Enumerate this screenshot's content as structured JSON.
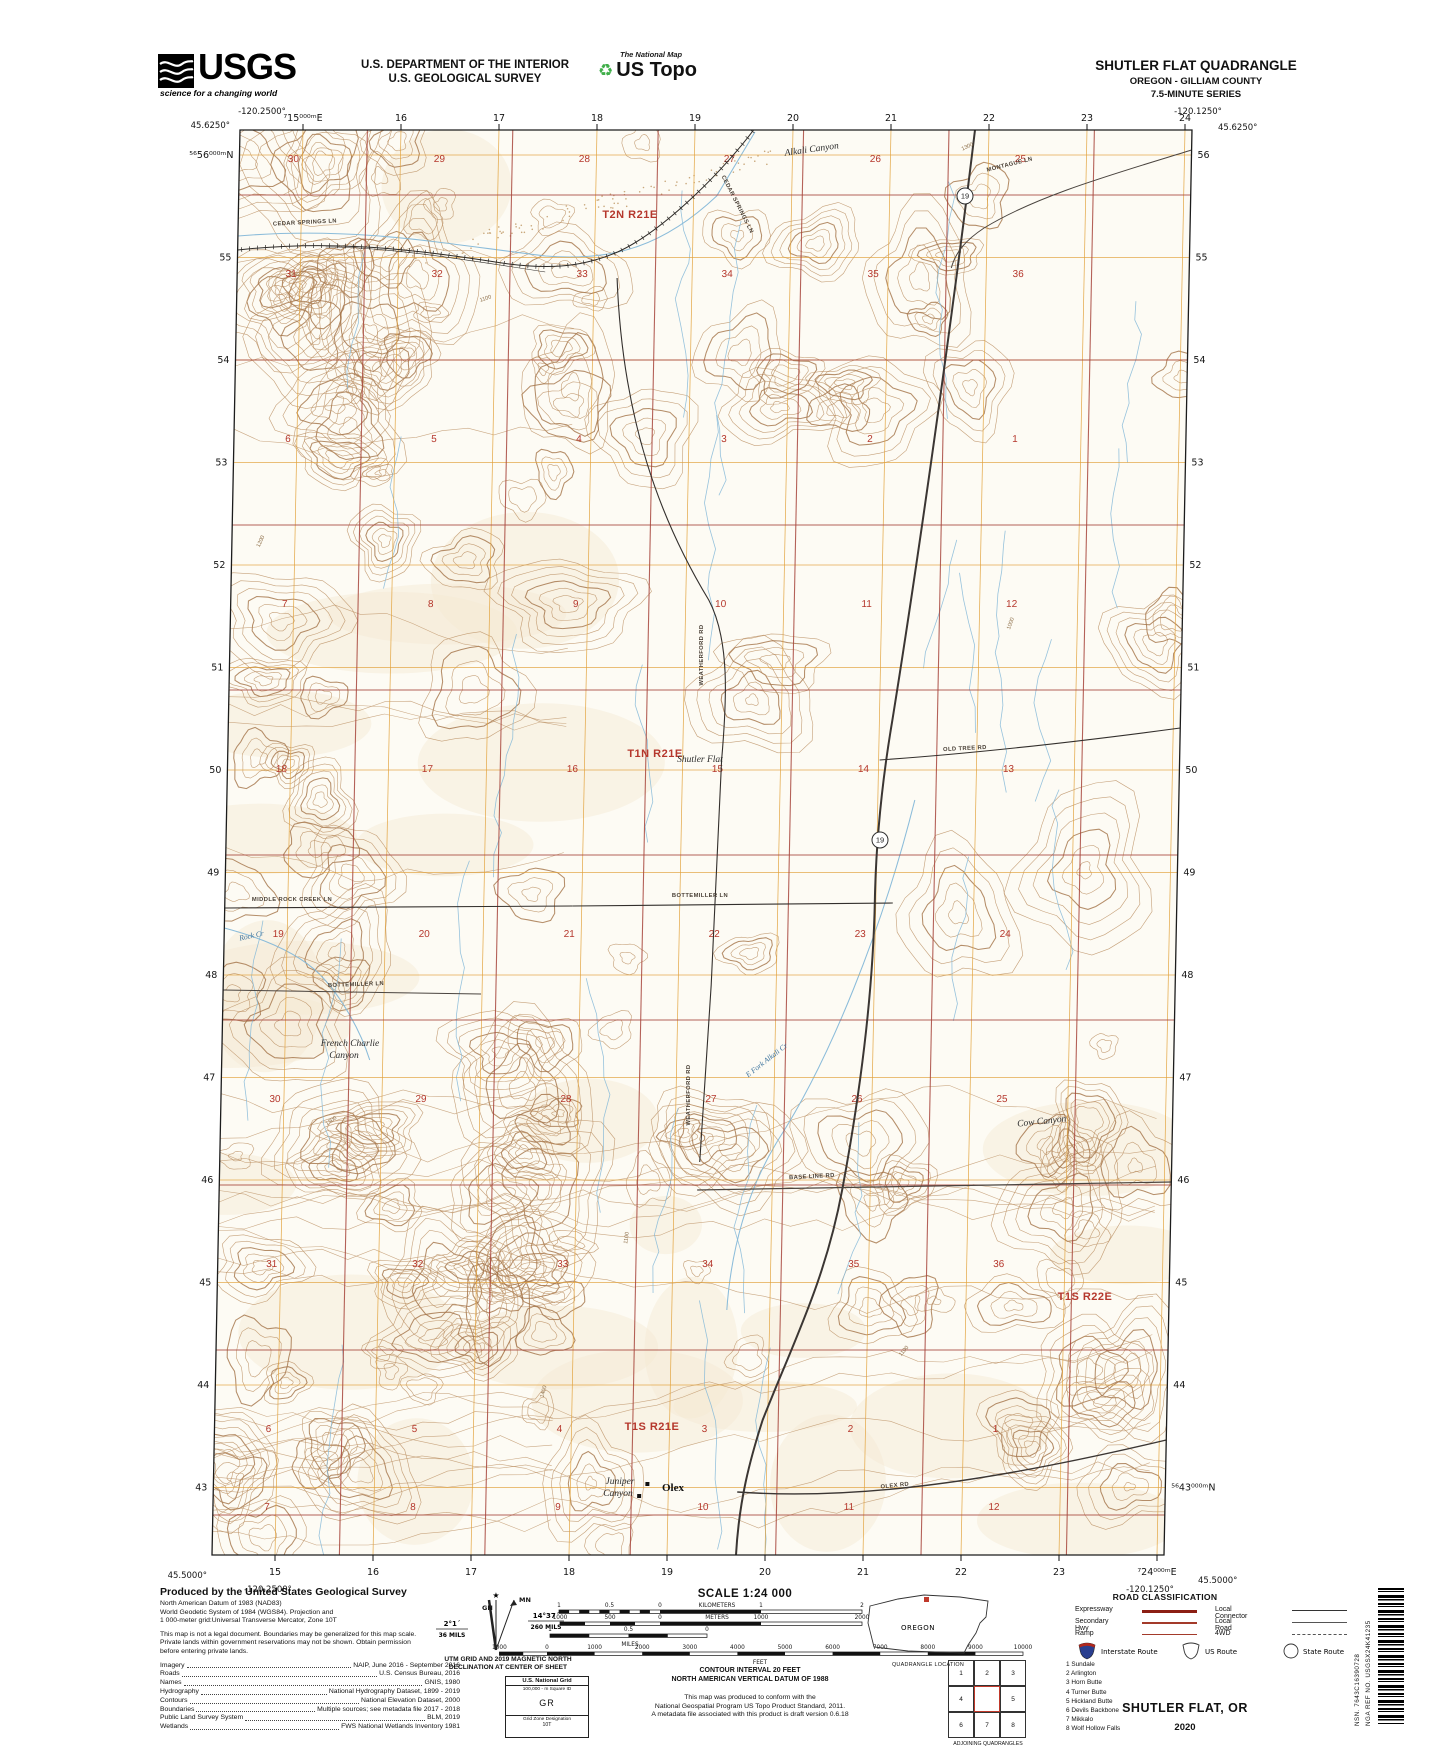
{
  "header": {
    "logo_text": "USGS",
    "logo_tagline": "science for a changing world",
    "dept1": "U.S. DEPARTMENT OF THE INTERIOR",
    "dept2": "U.S. GEOLOGICAL SURVEY",
    "natmap": "The National Map",
    "ustopo": "US Topo",
    "title": "SHUTLER FLAT QUADRANGLE",
    "subtitle1": "OREGON - GILLIAM COUNTY",
    "subtitle2": "7.5-MINUTE SERIES"
  },
  "map": {
    "corners": {
      "nw_lon": "-120.2500°",
      "nw_lat": "45.6250°",
      "ne_lon": "-120.1250°",
      "ne_lat": "45.6250°",
      "sw_lat": "45.5000°",
      "sw_lon": "-120.2500°",
      "se_lon": "-120.1250°",
      "se_lat": "45.5000°"
    },
    "ticks_top": [
      "⁷15⁰⁰⁰ᵐE",
      "16",
      "17",
      "18",
      "19",
      "20",
      "21",
      "22",
      "23",
      "24"
    ],
    "ticks_bottom": [
      "15",
      "16",
      "17",
      "18",
      "19",
      "20",
      "21",
      "22",
      "23",
      "⁷24⁰⁰⁰ᵐE"
    ],
    "ticks_left": [
      "⁵⁶56⁰⁰⁰ᵐN",
      "55",
      "54",
      "53",
      "52",
      "51",
      "50",
      "49",
      "48",
      "47",
      "46",
      "45",
      "44",
      "43"
    ],
    "ticks_right": [
      "56",
      "55",
      "54",
      "53",
      "52",
      "51",
      "50",
      "49",
      "48",
      "47",
      "46",
      "45",
      "44",
      "⁵⁶43⁰⁰⁰ᵐN"
    ],
    "township_labels": [
      {
        "text": "T2N R21E",
        "x": 630,
        "y": 218
      },
      {
        "text": "T1N R21E",
        "x": 655,
        "y": 757
      },
      {
        "text": "T1S R21E",
        "x": 652,
        "y": 1430
      },
      {
        "text": "T1S R22E",
        "x": 1085,
        "y": 1300
      }
    ],
    "section_grid": {
      "col_x": [
        266,
        412,
        557,
        702,
        848,
        993
      ],
      "rows": [
        {
          "y": 162,
          "nums": [
            "30",
            "29",
            "28",
            "27",
            "26",
            "25"
          ]
        },
        {
          "y": 277,
          "nums": [
            "31",
            "32",
            "33",
            "34",
            "35",
            "36"
          ]
        },
        {
          "y": 442,
          "nums": [
            "6",
            "5",
            "4",
            "3",
            "2",
            "1"
          ]
        },
        {
          "y": 607,
          "nums": [
            "7",
            "8",
            "9",
            "10",
            "11",
            "12"
          ]
        },
        {
          "y": 772,
          "nums": [
            "18",
            "17",
            "16",
            "15",
            "14",
            "13"
          ]
        },
        {
          "y": 937,
          "nums": [
            "19",
            "20",
            "21",
            "22",
            "23",
            "24"
          ]
        },
        {
          "y": 1102,
          "nums": [
            "30",
            "29",
            "28",
            "27",
            "26",
            "25"
          ]
        },
        {
          "y": 1267,
          "nums": [
            "31",
            "32",
            "33",
            "34",
            "35",
            "36"
          ]
        },
        {
          "y": 1432,
          "nums": [
            "6",
            "5",
            "4",
            "3",
            "2",
            "1"
          ]
        },
        {
          "y": 1510,
          "nums": [
            "7",
            "8",
            "9",
            "10",
            "11",
            "12"
          ]
        }
      ]
    },
    "place_labels": [
      {
        "text": "Alkali Canyon",
        "x": 812,
        "y": 152,
        "rot": -8
      },
      {
        "text": "Shutler Flat",
        "x": 700,
        "y": 762,
        "rot": 0
      },
      {
        "text": "French Charlie",
        "x": 350,
        "y": 1046,
        "rot": 0
      },
      {
        "text": "Canyon",
        "x": 344,
        "y": 1058,
        "rot": 0
      },
      {
        "text": "Cow Canyon",
        "x": 1042,
        "y": 1124,
        "rot": -6
      },
      {
        "text": "Juniper",
        "x": 620,
        "y": 1484,
        "rot": 0
      },
      {
        "text": "Canyon",
        "x": 618,
        "y": 1496,
        "rot": 0
      }
    ],
    "town_label": {
      "text": "Olex",
      "x": 662,
      "y": 1491
    },
    "road_labels": [
      {
        "text": "CEDAR SPRINGS LN",
        "x": 305,
        "y": 224,
        "rot": -3
      },
      {
        "text": "CEDAR SPRINGS LN",
        "x": 736,
        "y": 205,
        "rot": 63
      },
      {
        "text": "MONTAGUE LN",
        "x": 1010,
        "y": 166,
        "rot": -14
      },
      {
        "text": "WEATHERFORD RD",
        "x": 703,
        "y": 655,
        "rot": -90
      },
      {
        "text": "WEATHERFORD RD",
        "x": 690,
        "y": 1095,
        "rot": -90
      },
      {
        "text": "OLD TREE RD",
        "x": 965,
        "y": 750,
        "rot": -3
      },
      {
        "text": "BOTTEMILLER LN",
        "x": 700,
        "y": 897,
        "rot": 0
      },
      {
        "text": "BOTTEMILLER LN",
        "x": 356,
        "y": 986,
        "rot": -2
      },
      {
        "text": "MIDDLE ROCK CREEK LN",
        "x": 292,
        "y": 901,
        "rot": 0
      },
      {
        "text": "BASE LINE RD",
        "x": 812,
        "y": 1178,
        "rot": -3
      },
      {
        "text": "OLEX RD",
        "x": 895,
        "y": 1487,
        "rot": -6
      }
    ],
    "water_labels": [
      {
        "text": "Rock Cr",
        "x": 252,
        "y": 938,
        "rot": -12
      },
      {
        "text": "E Fork Alkali Cr",
        "x": 768,
        "y": 1062,
        "rot": -38
      }
    ],
    "route_shields": [
      {
        "num": "19",
        "x": 965,
        "y": 196
      },
      {
        "num": "19",
        "x": 880,
        "y": 840
      }
    ],
    "contour_labels": [
      {
        "text": "1100",
        "x": 486,
        "y": 300,
        "rot": -18
      },
      {
        "text": "1200",
        "x": 262,
        "y": 542,
        "rot": -65
      },
      {
        "text": "1300",
        "x": 332,
        "y": 1122,
        "rot": -35
      },
      {
        "text": "1400",
        "x": 545,
        "y": 1392,
        "rot": -75
      },
      {
        "text": "1100",
        "x": 628,
        "y": 1238,
        "rot": -82
      },
      {
        "text": "1300",
        "x": 968,
        "y": 148,
        "rot": -25
      },
      {
        "text": "1000",
        "x": 1012,
        "y": 624,
        "rot": -70
      },
      {
        "text": "1100",
        "x": 905,
        "y": 1352,
        "rot": -50
      }
    ]
  },
  "footer": {
    "produced_by": "Produced by the United States Geological Survey",
    "datum_lines": [
      "North American Datum of 1983 (NAD83)",
      "World Geodetic System of 1984 (WGS84).  Projection and",
      "1 000-meter grid:Universal Transverse Mercator, Zone 10T"
    ],
    "disclaimer": "This map is not a legal document. Boundaries may be generalized for this map scale. Private lands within government reservations may not be shown. Obtain permission before entering private lands.",
    "sources": [
      [
        "Imagery",
        "NAIP, June 2016 - September 2016"
      ],
      [
        "Roads",
        "U.S. Census Bureau, 2016"
      ],
      [
        "Names",
        "GNIS, 1980"
      ],
      [
        "Hydrography",
        "National Hydrography Dataset, 1899 - 2019"
      ],
      [
        "Contours",
        "National Elevation Dataset, 2000"
      ],
      [
        "Boundaries",
        "Multiple sources; see metadata file 2017 - 2018"
      ],
      [
        "Public Land Survey System",
        "BLM, 2019"
      ],
      [
        "Wetlands",
        "FWS National Wetlands Inventory 1981"
      ]
    ],
    "declination": {
      "gn": "GN",
      "mn": "MN",
      "gn_deg": "2°1´",
      "gn_mils": "36 MILS",
      "mn_deg": "14°37´",
      "mn_mils": "260 MILS",
      "caption1": "UTM GRID AND 2019 MAGNETIC NORTH",
      "caption2": "DECLINATION AT CENTER OF SHEET"
    },
    "usng": {
      "title": "U.S. National Grid",
      "sq_label": "100,000 - m Square ID",
      "square": "GR",
      "zone_label": "Grid Zone Designation",
      "zone": "10T"
    },
    "scale": {
      "title": "SCALE 1:24 000",
      "km_labels": [
        "1",
        "0.5",
        "0",
        "1",
        "2"
      ],
      "km_unit": "KILOMETERS",
      "m_labels": [
        "1000",
        "500",
        "0",
        "1000",
        "2000"
      ],
      "m_unit": "METERS",
      "mi_labels": [
        "1",
        "0.5",
        "0"
      ],
      "mi_unit": "MILES",
      "ft_labels": [
        "1000",
        "0",
        "1000",
        "2000",
        "3000",
        "4000",
        "5000",
        "6000",
        "7000",
        "8000",
        "9000",
        "10000"
      ],
      "ft_unit": "FEET"
    },
    "contour_note1": "CONTOUR INTERVAL 20 FEET",
    "contour_note2": "NORTH AMERICAN VERTICAL DATUM OF 1988",
    "conform_lines": [
      "This map was produced to conform with the",
      "National Geospatial Program US Topo Product Standard, 2011.",
      "A metadata file associated with this product is draft version 0.6.18"
    ],
    "state_name": "OREGON",
    "quad_location_caption": "QUADRANGLE LOCATION",
    "adjoining": {
      "cells": [
        "1",
        "2",
        "3",
        "4",
        "",
        "5",
        "6",
        "7",
        "8"
      ],
      "names": [
        "1 Sundale",
        "2 Arlington",
        "3 Horn Butte",
        "4 Turner Butte",
        "5 Hickland Butte",
        "6 Devils Backbone",
        "7 Mikkalo",
        "8 Wolf Hollow Falls"
      ],
      "caption": "ADJOINING QUADRANGLES"
    },
    "road_class": {
      "title": "ROAD CLASSIFICATION",
      "left": [
        "Expressway",
        "Secondary Hwy",
        "Ramp"
      ],
      "right": [
        "Local Connector",
        "Local Road",
        "4WD"
      ],
      "shield_labels": [
        "Interstate Route",
        "US Route",
        "State Route"
      ]
    },
    "sheet_title": "SHUTLER FLAT,  OR",
    "sheet_year": "2020",
    "nsn": "NSN.  7643C16390728",
    "nga": "NGA REF NO.  USGSX24K41235"
  },
  "colors": {
    "contour": "#b98e60",
    "contour_index": "#a5754a",
    "grid_utm": "#e2a23c",
    "grid_section": "#a8473d",
    "water": "#85b8d8",
    "road_major": "#3b3633",
    "red_text": "#b5372c",
    "paper": "#fdfbf4"
  }
}
